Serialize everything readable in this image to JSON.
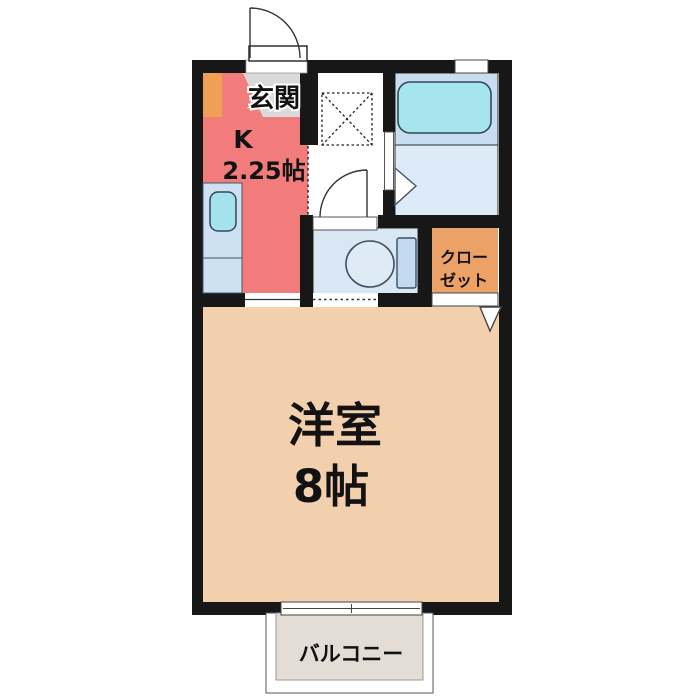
{
  "floorplan": {
    "labels": {
      "genkan": "玄関",
      "kitchen_type": "K",
      "kitchen_size": "2.25帖",
      "main_room": "洋室",
      "main_room_size": "8帖",
      "closet_line1": "クロー",
      "closet_line2": "ゼット",
      "balcony": "バルコニー"
    },
    "colors": {
      "wall": "#171717",
      "kitchen": "#f27c7c",
      "genkan_floor": "#d9d9d9",
      "kitchen_unit_orange": "#f0a055",
      "sink_counter": "#cde1f3",
      "sink_basin": "#a5e3ec",
      "bath_upper": "#c8ddf0",
      "bath_lower": "#dcebf7",
      "bathtub": "#a6e5ee",
      "toilet_room": "#d9e6f4",
      "toilet_tank": "#c3d9ee",
      "toilet_bowl": "#dfeaf7",
      "closet": "#eca266",
      "main_room": "#f2cfad",
      "balcony": "#e3ddd5"
    }
  }
}
